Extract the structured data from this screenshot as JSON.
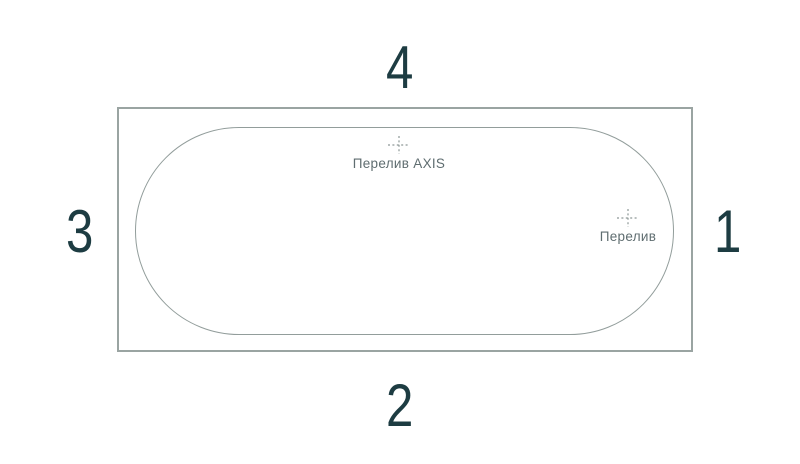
{
  "diagram": {
    "type": "bathtub-top-view-scheme",
    "background_color": "#ffffff",
    "rim_outline_color": "#9aa4a2",
    "basin_outline_color": "#929d9b",
    "number_color": "#1d3c42",
    "label_color": "#5f6d70",
    "side_numbers": {
      "top": "4",
      "right": "1",
      "bottom": "2",
      "left": "3"
    },
    "markers": [
      {
        "id": "overflow-axis",
        "label": "Перелив AXIS"
      },
      {
        "id": "overflow",
        "label": "Перелив"
      }
    ]
  }
}
